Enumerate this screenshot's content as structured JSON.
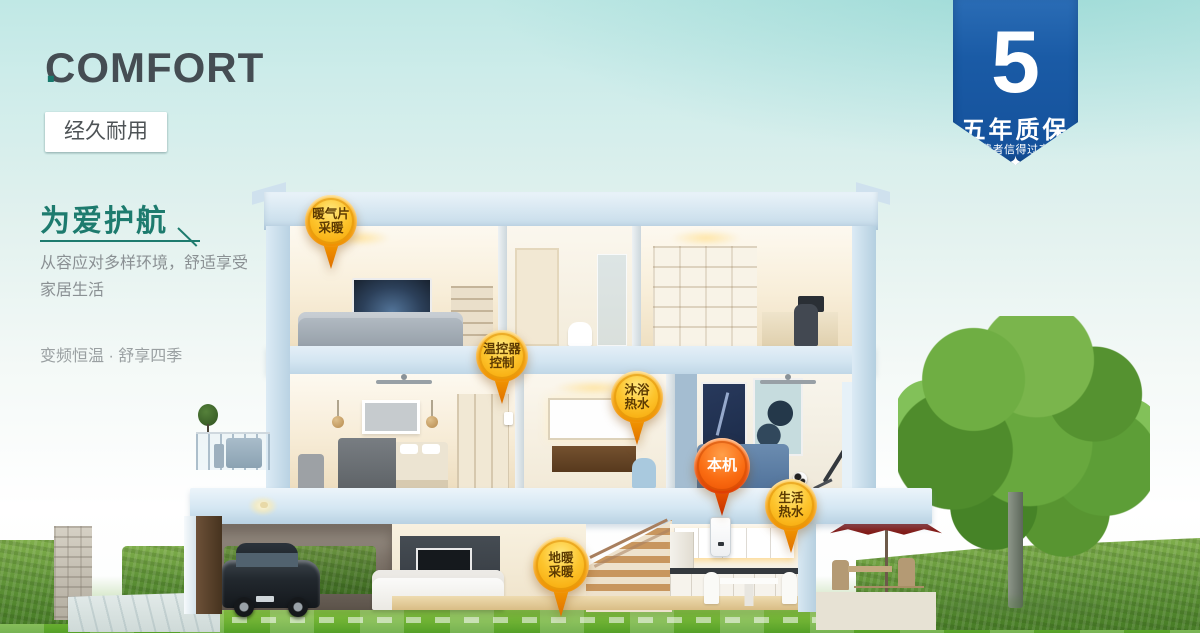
{
  "brand": {
    "name": "COMFORT",
    "dot": "."
  },
  "feature_tags": [
    "远程掌控",
    "静音运行",
    "多重保护",
    "经久耐用"
  ],
  "headline": {
    "title": "为爱护航",
    "description": "从容应对多样环境，舒适享受\n家居生活",
    "tagline": "变频恒温 · 舒享四季"
  },
  "warranty_badge": {
    "number": "5",
    "title": "五年质保",
    "subtitle": "消费者信得过产品",
    "stars": [
      "✦",
      "✦",
      "✦",
      "✦",
      "✦"
    ]
  },
  "pins": {
    "radiator_heating": {
      "label": "暖气片\n采暖"
    },
    "thermostat_control": {
      "label": "温控器\n控制"
    },
    "shower_hot_water": {
      "label": "沐浴\n热水"
    },
    "main_unit": {
      "label": "本机"
    },
    "domestic_hot_water": {
      "label": "生活\n热水"
    },
    "floor_heating": {
      "label": "地暖\n采暖"
    }
  },
  "colors": {
    "accent_teal": "#1d7b6e",
    "badge_blue": "#1a5ba6",
    "pin_yellow": "#f9a602",
    "pin_red": "#e84d0b"
  }
}
